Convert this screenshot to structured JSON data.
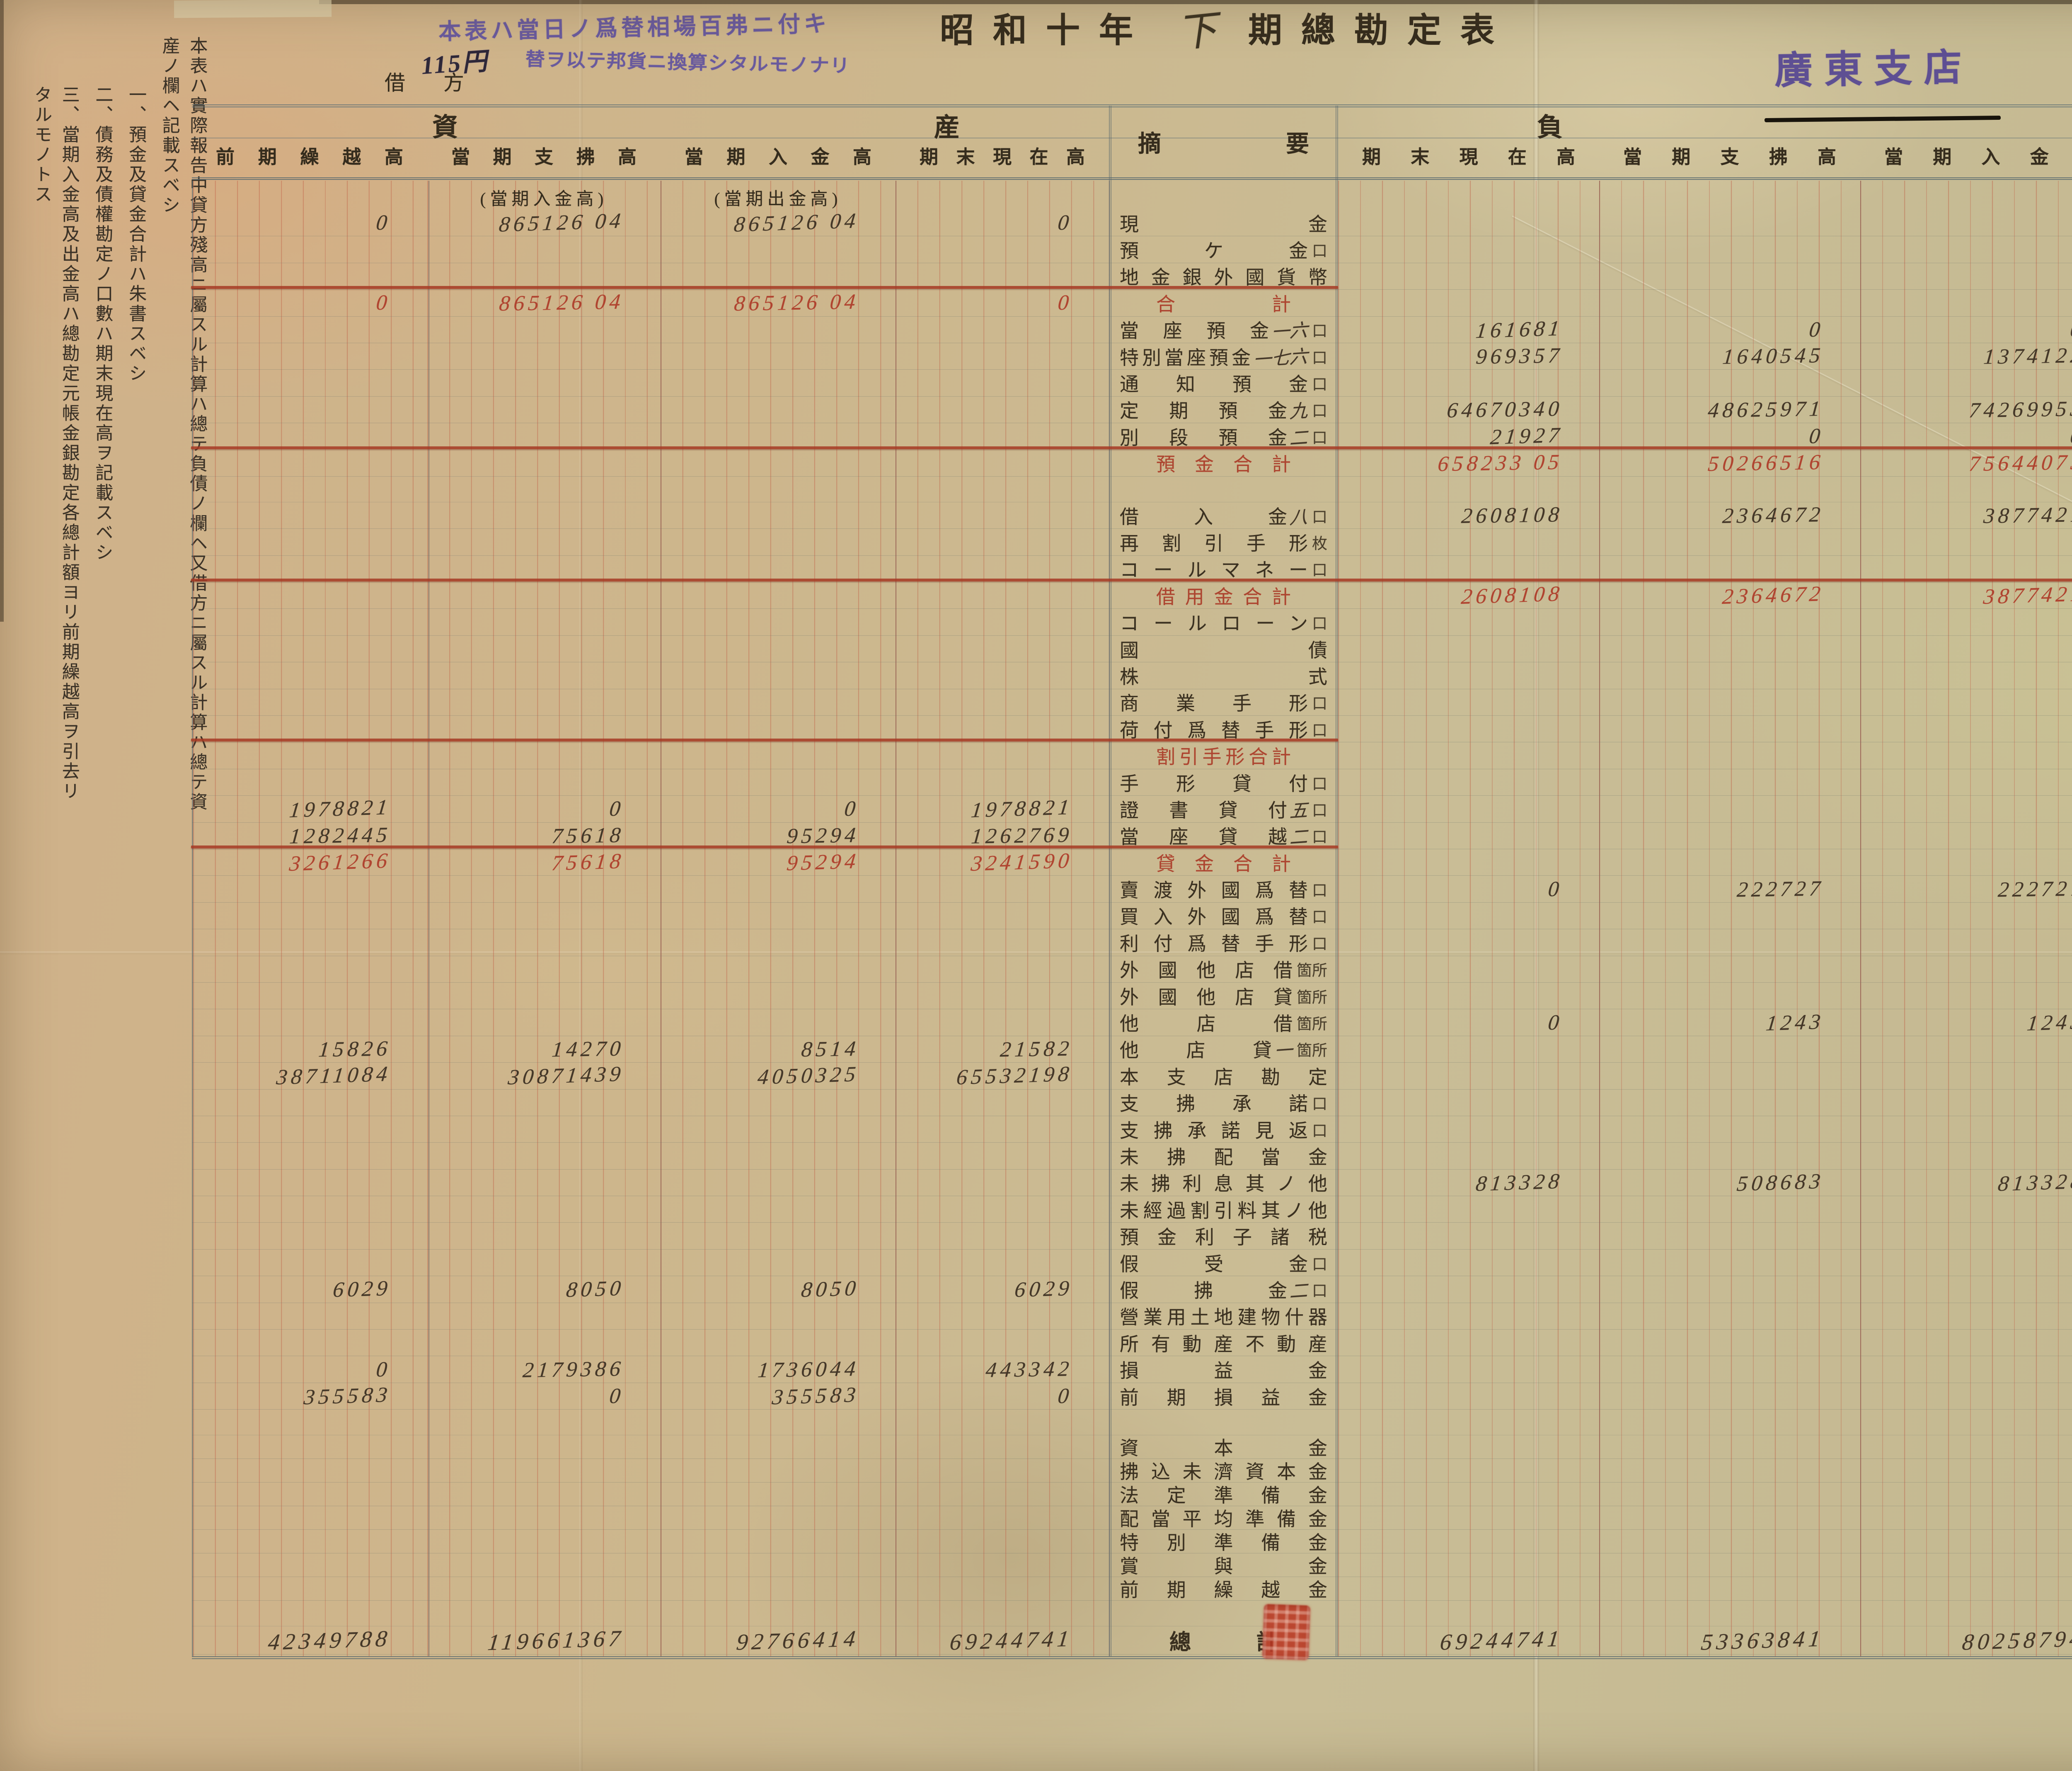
{
  "title": {
    "prefix": "昭和十年",
    "period": "下",
    "suffix": "期總勘定表"
  },
  "branch": "廣東支店",
  "labels": {
    "debit": "借方",
    "credit": "貸方"
  },
  "purple_note": {
    "line1": "本表ハ當日ノ爲替相場百弗ニ付キ",
    "amount": "115円",
    "line2": "替ヲ以テ邦貨ニ換算シタルモノナリ"
  },
  "margin_notes": [
    "本表ハ實際報告中貸方殘高ニ屬スル計算ハ總テ負債ノ欄ヘ又借方ニ屬スル計算ハ總テ資産ノ欄ヘ記載スベシ",
    "一、預金及貸金合計ハ朱書スベシ",
    "二、債務及債權勘定ノ口數ハ期末現在高ヲ記載スベシ",
    "三、當期入金高及出金高ハ總勘定元帳金銀勘定各總計額ヨリ前期繰越高ヲ引去リタルモノトス"
  ],
  "sections": {
    "assets": "資産",
    "liabilities": "負債",
    "summary": "摘要"
  },
  "left_table": {
    "headers": [
      "前期繰越高",
      "當期支拂高",
      "當期入金高",
      "期末現在高"
    ],
    "subheaders": [
      "(當期入金高)",
      "(當期出金高)"
    ]
  },
  "right_table": {
    "headers": [
      "期末現在高",
      "當期支拂高",
      "當期入金高",
      "前期繰越高"
    ]
  },
  "colors": {
    "red_ink": "#b04430",
    "purple_ink": "#695a9d",
    "paper": "#c9b58c",
    "rule_red": "#a63a24"
  },
  "rows": [
    {
      "label": "現金",
      "left": [
        "0",
        "865126 04",
        "865126 04",
        "0"
      ]
    },
    {
      "label": "預ケ金",
      "unit": "口"
    },
    {
      "label": "地金銀外國貨幣",
      "rule": "mid"
    },
    {
      "label": "合計",
      "style": "red",
      "left": [
        "0",
        "865126 04",
        "865126 04",
        "0"
      ]
    },
    {
      "label": "當座預金",
      "count": "一六",
      "unit": "口",
      "right": [
        "161681",
        "0",
        "0",
        "161681"
      ]
    },
    {
      "label": "特別當座預金",
      "count": "一七六",
      "unit": "口",
      "right": [
        "969357",
        "1640545",
        "1374122",
        "1235780"
      ]
    },
    {
      "label": "通知預金",
      "unit": "口"
    },
    {
      "label": "定期預金",
      "count": "九",
      "unit": "口",
      "right": [
        "64670340",
        "48625971",
        "74269953",
        "39026358"
      ]
    },
    {
      "label": "別段預金",
      "count": "二",
      "unit": "口",
      "right": [
        "21927",
        "0",
        "0",
        "21927"
      ],
      "rule": "full"
    },
    {
      "label": "預金合計",
      "style": "red",
      "right": [
        "658233 05",
        "50266516",
        "75644075",
        "40445746"
      ]
    },
    {
      "style": "gap"
    },
    {
      "label": "借入金",
      "count": "八",
      "unit": "口",
      "right": [
        "2608108",
        "2364672",
        "3877421",
        "1395359"
      ]
    },
    {
      "label": "再割引手形",
      "unit": "枚"
    },
    {
      "label": "コールマネー",
      "unit": "口",
      "rule": "full"
    },
    {
      "label": "借用金合計",
      "style": "red",
      "right": [
        "2608108",
        "2364672",
        "3877421",
        "1395359"
      ]
    },
    {
      "label": "コールローン",
      "unit": "口"
    },
    {
      "label": "國債"
    },
    {
      "label": "株式"
    },
    {
      "label": "商業手形",
      "unit": "口"
    },
    {
      "label": "荷付爲替手形",
      "unit": "口",
      "rule": "mid"
    },
    {
      "label": "割引手形合計",
      "style": "red"
    },
    {
      "label": "手形貸付",
      "unit": "口"
    },
    {
      "label": "證書貸付",
      "count": "五",
      "unit": "口",
      "left": [
        "1978821",
        "0",
        "0",
        "1978821"
      ]
    },
    {
      "label": "當座貸越",
      "count": "二",
      "unit": "口",
      "left": [
        "1282445",
        "75618",
        "95294",
        "1262769"
      ],
      "rule": "mid"
    },
    {
      "label": "貸金合計",
      "style": "red",
      "left": [
        "3261266",
        "75618",
        "95294",
        "3241590"
      ]
    },
    {
      "label": "賣渡外國爲替",
      "unit": "口",
      "right": [
        "0",
        "222727",
        "222727",
        "0"
      ]
    },
    {
      "label": "買入外國爲替",
      "unit": "口"
    },
    {
      "label": "利付爲替手形",
      "unit": "口"
    },
    {
      "label": "外國他店借",
      "unit": "箇所"
    },
    {
      "label": "外國他店貸",
      "unit": "箇所"
    },
    {
      "label": "他店借",
      "unit": "箇所",
      "right": [
        "0",
        "1243",
        "1243",
        "0"
      ]
    },
    {
      "label": "他店貸",
      "count": "一",
      "unit": "箇所",
      "left": [
        "15826",
        "14270",
        "8514",
        "21582"
      ]
    },
    {
      "label": "本支店勘定",
      "left": [
        "38711084",
        "30871439",
        "4050325",
        "65532198"
      ]
    },
    {
      "label": "支拂承諾",
      "unit": "口"
    },
    {
      "label": "支拂承諾見返",
      "unit": "口"
    },
    {
      "label": "未拂配當金"
    },
    {
      "label": "未拂利息其ノ他",
      "right": [
        "813328",
        "508683",
        "813328",
        "508683"
      ]
    },
    {
      "label": "未經過割引料其ノ他"
    },
    {
      "label": "預金利子諸税"
    },
    {
      "label": "假受金",
      "unit": "口"
    },
    {
      "label": "假拂金",
      "count": "二",
      "unit": "口",
      "left": [
        "6029",
        "8050",
        "8050",
        "6029"
      ]
    },
    {
      "label": "營業用土地建物什器"
    },
    {
      "label": "所有動産不動産"
    },
    {
      "label": "損益金",
      "left": [
        "0",
        "2179386",
        "1736044",
        "443342"
      ]
    },
    {
      "label": "前期損益金",
      "left": [
        "355583",
        "0",
        "355583",
        "0"
      ]
    },
    {
      "style": "gap"
    },
    {
      "label": "資本金",
      "style": "cap"
    },
    {
      "label": "拂込未濟資本金",
      "style": "cap"
    },
    {
      "label": "法定準備金",
      "style": "cap"
    },
    {
      "label": "配當平均準備金",
      "style": "cap"
    },
    {
      "label": "特別準備金",
      "style": "cap"
    },
    {
      "label": "賞與金",
      "style": "cap"
    },
    {
      "label": "前期繰越金",
      "style": "cap"
    },
    {
      "style": "gap"
    },
    {
      "label": "總計",
      "style": "total",
      "left": [
        "42349788",
        "119661367",
        "92766414",
        "69244741"
      ],
      "right": [
        "69244741",
        "53363841",
        "80258794",
        "42349788"
      ]
    }
  ]
}
